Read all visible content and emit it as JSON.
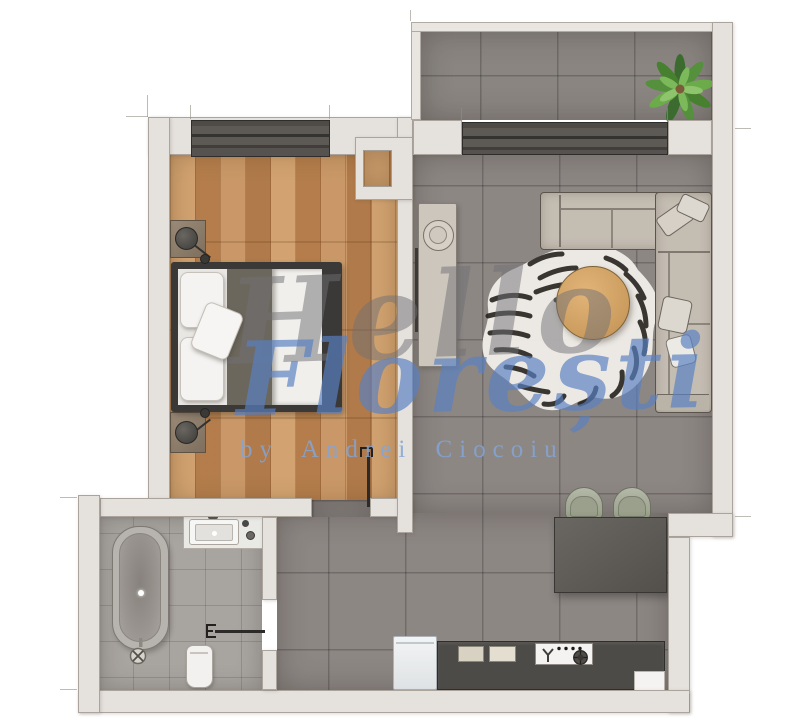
{
  "watermark": {
    "script_word": "Hello",
    "name": "Florești",
    "byline": "by Andrei Ciocoiu"
  },
  "palette": {
    "background": "#ffffff",
    "wall": "#e5e1dc",
    "wall_outline": "#aaa49c",
    "wood_floor": "#c18a57",
    "tile_floor": "#8d8784",
    "bath_tile": "#a8a4a0",
    "window_frame": "#57544f",
    "bed_frame": "#3a3937",
    "blanket": "#6c675c",
    "linen": "#f1efec",
    "sofa": "#c4bdb2",
    "coffee_table": "#d3a468",
    "dining_table": "#5d5a56",
    "chair": "#a0a593",
    "kitchen_counter": "#4d4b47",
    "rug_base": "#efede8",
    "rug_stripes": "#26231f",
    "plant_green": "#55903c",
    "watermark_gray": "#757578",
    "watermark_blue": "#5a80c2"
  },
  "furniture": [
    "double-bed",
    "nightstand",
    "table-lamp",
    "wardrobe-niche",
    "tall-cabinet",
    "corner-sofa",
    "zebra-rug",
    "round-coffee-table",
    "dining-table",
    "dining-chair",
    "kitchen-counter",
    "cooktop",
    "sink",
    "fridge",
    "bathtub",
    "vanity-sink",
    "toilet",
    "balcony-plant",
    "sliding-glass-door",
    "bedroom-window"
  ]
}
